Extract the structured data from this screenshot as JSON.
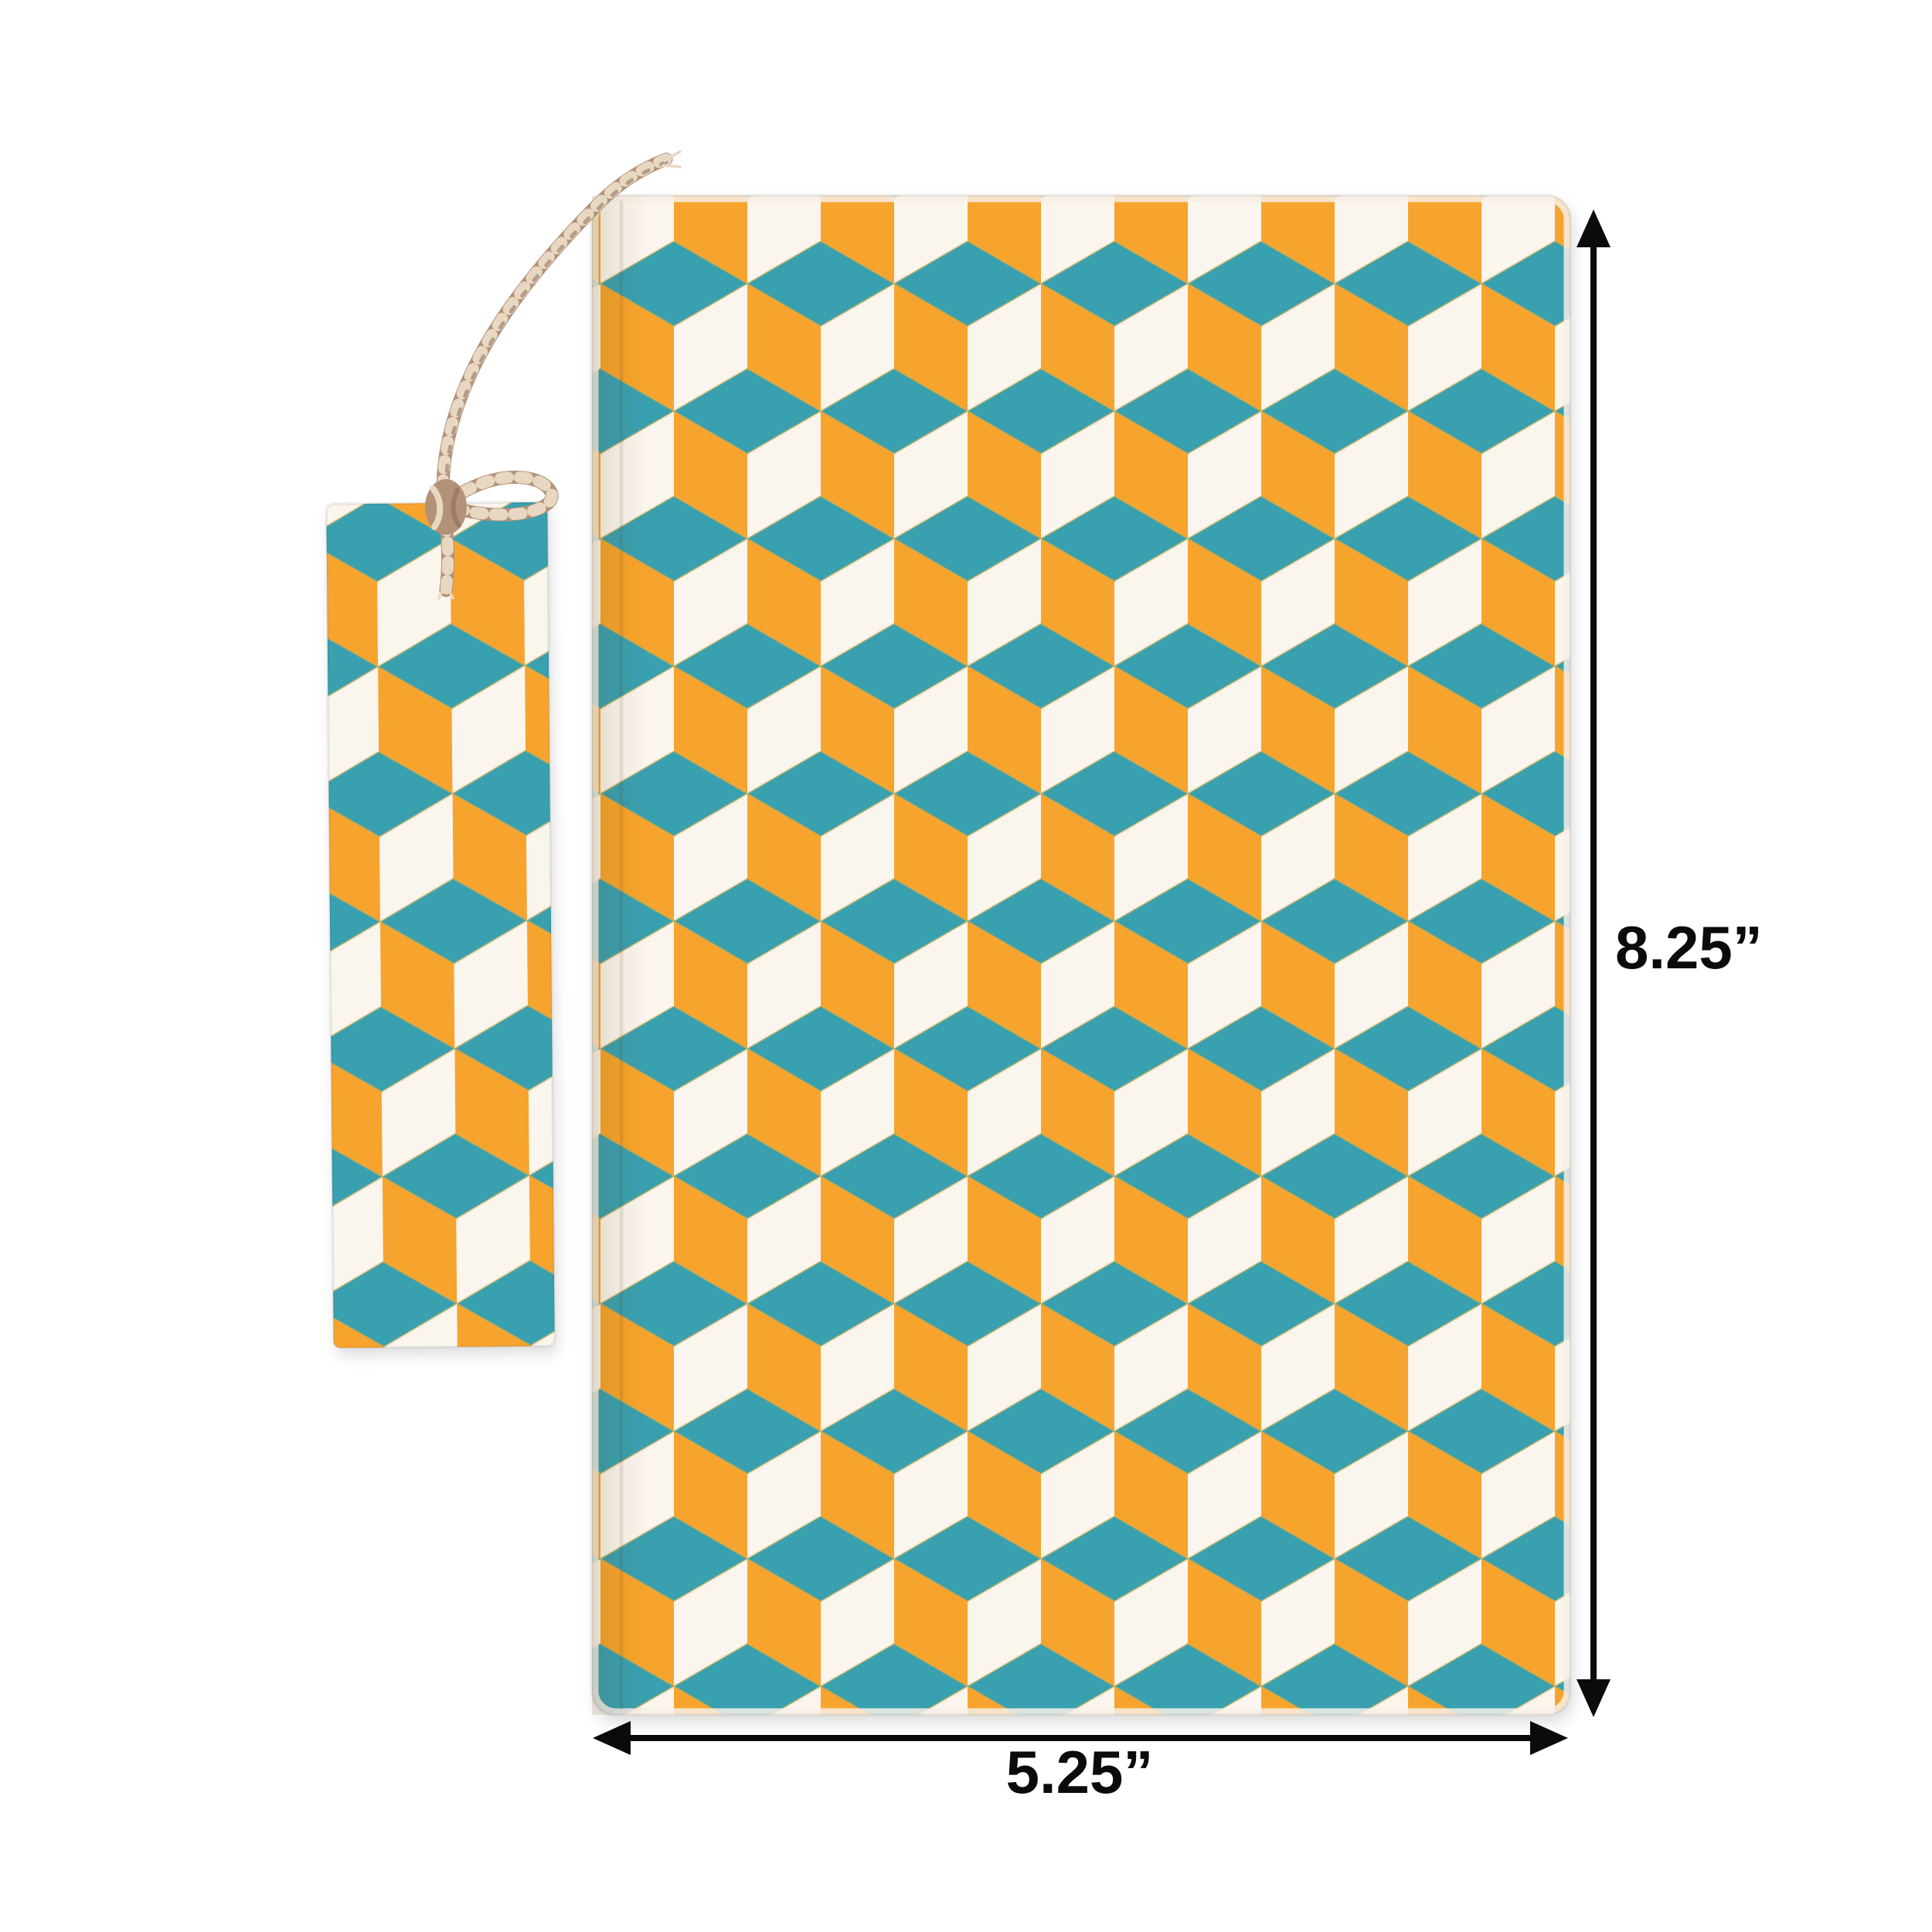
{
  "image": {
    "type": "product-photo",
    "subject": "Handmade paper notebook with isometric cube block-print cover, matching bookmark tied with jute twine, and printed size annotations"
  },
  "objects": {
    "notebook": "patterned notebook cover",
    "bookmark": "matching patterned bookmark",
    "twine": "jute twine tie with knot"
  },
  "annotations": {
    "height_label": "8.25”",
    "width_label": "5.25”"
  },
  "colors": {
    "orange": "#F7A42D",
    "teal": "#39A0AF",
    "paper-cream": "#F7F0E6",
    "paper-white": "#FAF5ED",
    "twine": "#B3927A",
    "twine-light": "#E8D8C2",
    "twine-dark": "#8C6E57",
    "print-overlap": "#D9A93C",
    "ink": "#0B0B0B",
    "background": "#FFFFFF"
  }
}
